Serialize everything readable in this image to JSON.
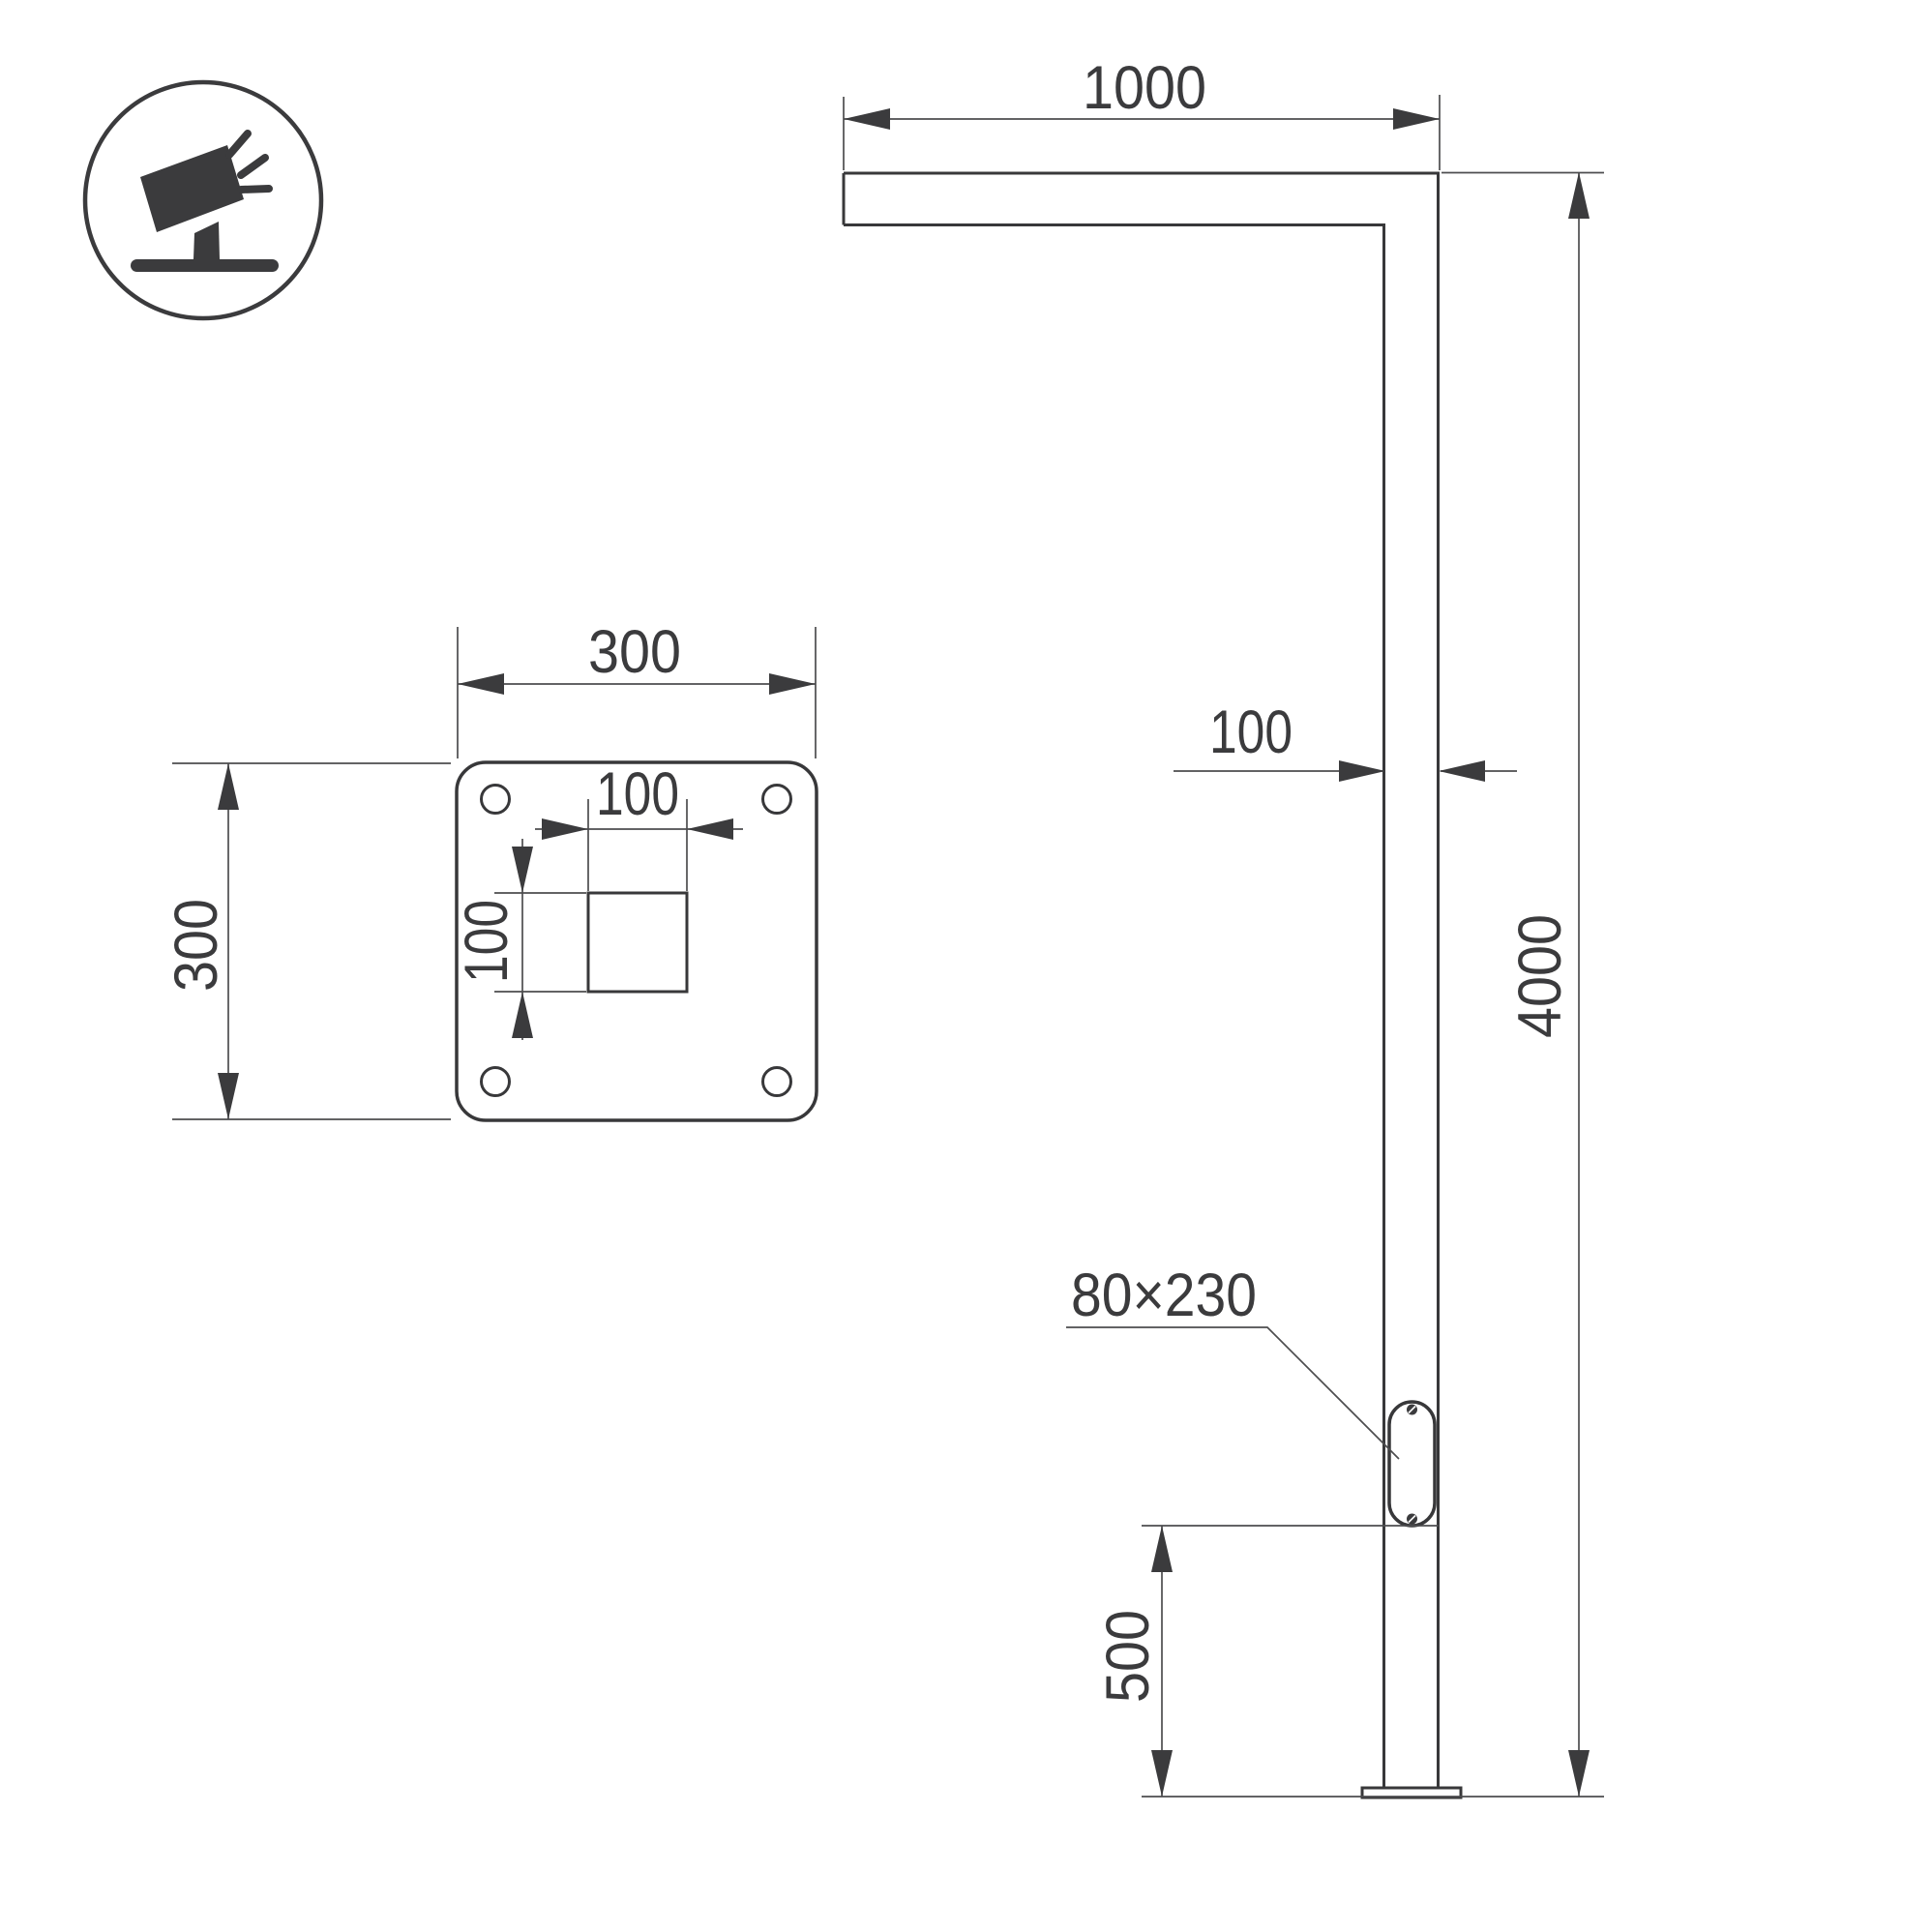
{
  "icon": {
    "name": "tilted-floodlight-on-ground-icon"
  },
  "dims": {
    "arm_length": "1000",
    "plate_width": "300",
    "plate_height": "300",
    "hole_width": "100",
    "hole_height": "100",
    "pole_width": "100",
    "pole_height": "4000",
    "door_label": "80×230",
    "door_offset": "500"
  },
  "colors": {
    "outline": "#38383a",
    "dimension_line": "#4d4d4f",
    "text": "#3b3b3d",
    "background": "#ffffff"
  }
}
